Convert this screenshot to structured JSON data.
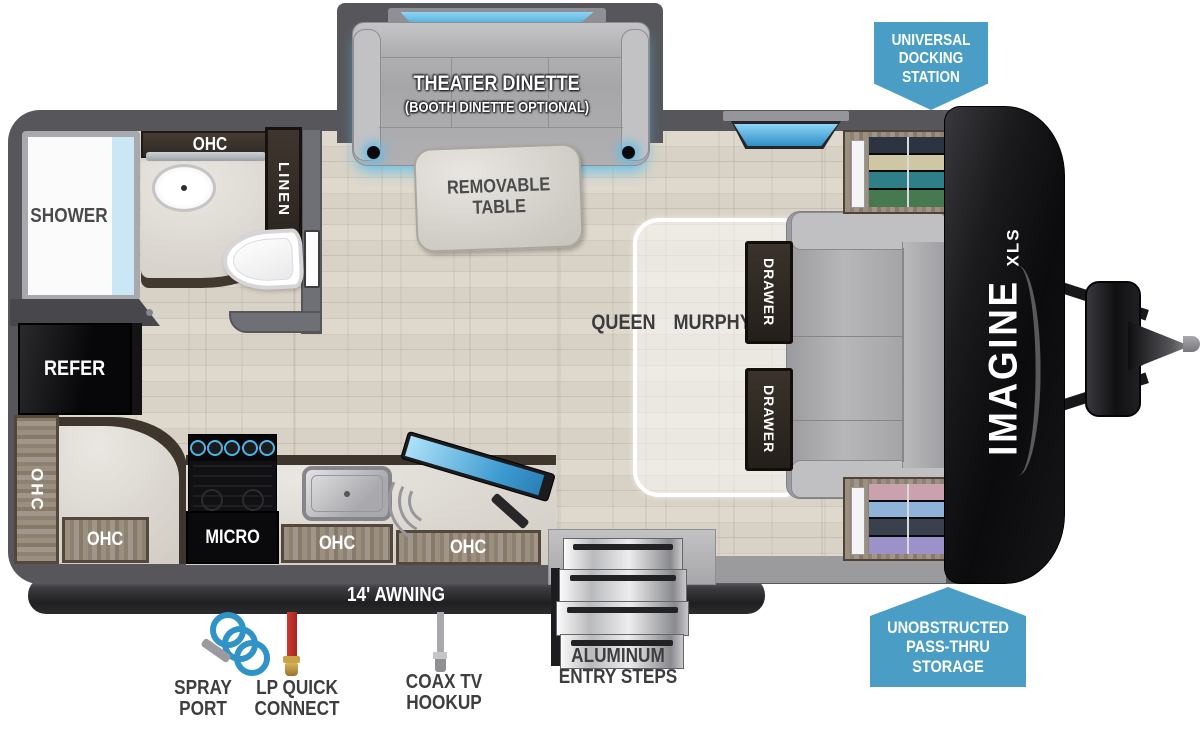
{
  "colors": {
    "accent_blue": "#4a9ec6",
    "wall_gray": "#57575b"
  },
  "callouts": {
    "docking_station": {
      "lines": [
        "UNIVERSAL",
        "DOCKING",
        "STATION"
      ]
    },
    "pass_thru": {
      "lines": [
        "UNOBSTRUCTED",
        "PASS-THRU",
        "STORAGE"
      ]
    }
  },
  "slide_out": {
    "title": "THEATER DINETTE",
    "subtitle": "(BOOTH DINETTE OPTIONAL)"
  },
  "living_area": {
    "table_lines": [
      "REMOVABLE",
      "TABLE"
    ],
    "bed_lines": [
      "QUEEN",
      "MURPHY",
      "BED"
    ],
    "drawers": [
      "DRAWER",
      "DRAWER"
    ]
  },
  "bathroom": {
    "shower": "SHOWER",
    "ohc": "OHC",
    "linen": "LINEN"
  },
  "kitchen": {
    "refer": "REFER",
    "micro": "MICRO",
    "ohc_wall": "OHC",
    "ohc_cabinets": [
      "OHC",
      "OHC",
      "OHC"
    ]
  },
  "exterior": {
    "awning": "14' AWNING",
    "steps_lines": [
      "ALUMINUM",
      "ENTRY STEPS"
    ],
    "spray_port_lines": [
      "SPRAY",
      "PORT"
    ],
    "lp_connect_lines": [
      "LP QUICK",
      "CONNECT"
    ],
    "coax_lines": [
      "COAX TV",
      "HOOKUP"
    ]
  },
  "brand": {
    "model": "IMAGINE",
    "trim": "XLS"
  }
}
